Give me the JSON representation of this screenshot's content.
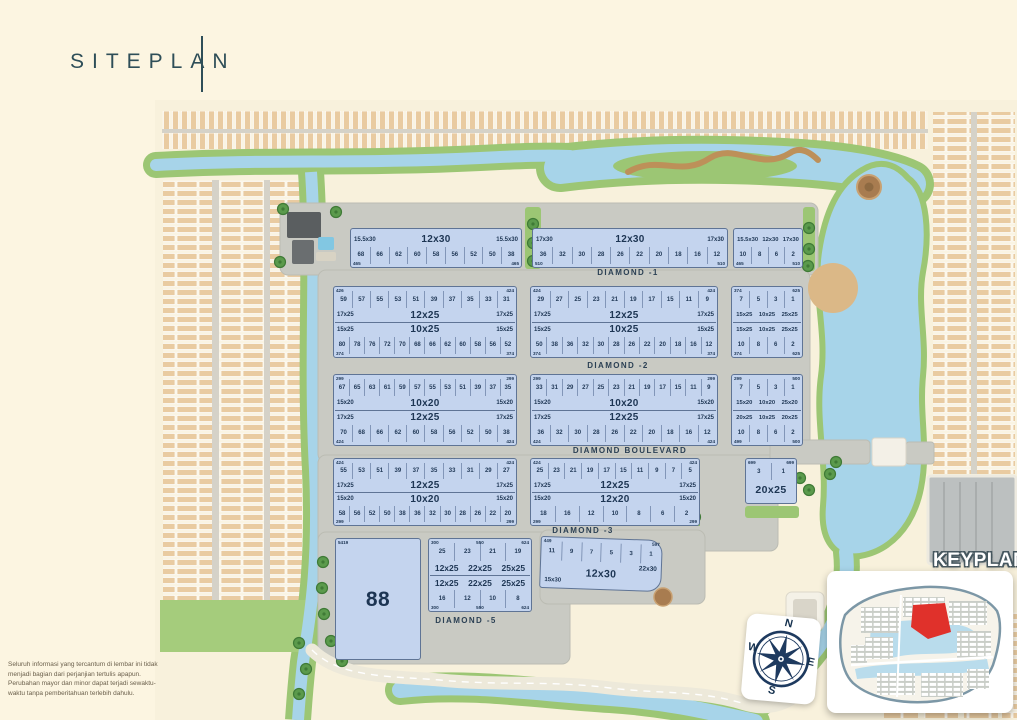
{
  "page": {
    "title": "SITEPLAN",
    "disclaimer": "Seluruh informasi yang tercantum di lembar ini tidak menjadi bagian dari perjanjian tertulis apapun. Perubahan mayor dan minor dapat terjadi sewaktu-waktu tanpa pemberitahuan terlebih dahulu."
  },
  "roads": [
    {
      "id": "diamond-1",
      "label": "DIAMOND -1"
    },
    {
      "id": "diamond-2",
      "label": "DIAMOND -2"
    },
    {
      "id": "diamond-boulevard",
      "label": "DIAMOND BOULEVARD"
    },
    {
      "id": "diamond-3",
      "label": "DIAMOND -3"
    },
    {
      "id": "diamond-5",
      "label": "DIAMOND -5"
    }
  ],
  "keyplan": {
    "label": "KEYPLAN"
  },
  "compass": {
    "n": "N",
    "e": "E",
    "s": "S",
    "w": "W"
  },
  "colors": {
    "lot_fill": "#C4D4EE",
    "lot_border": "#5F7495",
    "water": "#A7D4E9",
    "green": "#9CC674",
    "road_gray": "#C9CAC3",
    "text_navy": "#223A58",
    "keyplan_highlight": "#E0312B",
    "background_cream": "#FCF5E1",
    "title_color": "#2E4E58"
  },
  "blocks": [
    {
      "id": "b1",
      "corners": {
        "bl": "465",
        "br": "465"
      },
      "rows": [
        {
          "kind": "labels",
          "left": "15.5x30",
          "center": "12x30",
          "right": "15.5x30"
        },
        {
          "kind": "nums",
          "values": [
            "68",
            "66",
            "62",
            "60",
            "58",
            "56",
            "52",
            "50",
            "38"
          ]
        }
      ]
    },
    {
      "id": "b2",
      "corners": {
        "bl": "510",
        "br": "510"
      },
      "rows": [
        {
          "kind": "labels",
          "left": "17x30",
          "center": "12x30",
          "right": "17x30"
        },
        {
          "kind": "nums",
          "values": [
            "36",
            "32",
            "30",
            "28",
            "26",
            "22",
            "20",
            "18",
            "16",
            "12"
          ]
        }
      ]
    },
    {
      "id": "b3",
      "corners": {
        "bl": "465",
        "br": "510"
      },
      "rows": [
        {
          "kind": "labels3",
          "values": [
            "15.5x30",
            "12x30",
            "17x30"
          ]
        },
        {
          "kind": "nums",
          "values": [
            "10",
            "8",
            "6",
            "2"
          ]
        }
      ]
    },
    {
      "id": "b4",
      "corners": {
        "tl": "426",
        "tr": "424",
        "bl": "374",
        "br": "374"
      },
      "rows": [
        {
          "kind": "nums",
          "values": [
            "59",
            "57",
            "55",
            "53",
            "51",
            "39",
            "37",
            "35",
            "33",
            "31"
          ]
        },
        {
          "kind": "labels",
          "left": "17x25",
          "center": "12x25",
          "right": "17x25"
        },
        {
          "kind": "labels",
          "left": "15x25",
          "center": "10x25",
          "right": "15x25",
          "mid": true
        },
        {
          "kind": "nums",
          "values": [
            "80",
            "78",
            "76",
            "72",
            "70",
            "68",
            "66",
            "62",
            "60",
            "58",
            "56",
            "52"
          ]
        }
      ]
    },
    {
      "id": "b5",
      "corners": {
        "tl": "424",
        "tr": "424",
        "bl": "374",
        "br": "374"
      },
      "rows": [
        {
          "kind": "nums",
          "values": [
            "29",
            "27",
            "25",
            "23",
            "21",
            "19",
            "17",
            "15",
            "11",
            "9"
          ]
        },
        {
          "kind": "labels",
          "left": "17x25",
          "center": "12x25",
          "right": "17x25"
        },
        {
          "kind": "labels",
          "left": "15x25",
          "center": "10x25",
          "right": "15x25",
          "mid": true
        },
        {
          "kind": "nums",
          "values": [
            "50",
            "38",
            "36",
            "32",
            "30",
            "28",
            "26",
            "22",
            "20",
            "18",
            "16",
            "12"
          ]
        }
      ]
    },
    {
      "id": "b6",
      "corners": {
        "tl": "374",
        "tr": "625",
        "bl": "374",
        "br": "625"
      },
      "rows": [
        {
          "kind": "nums",
          "values": [
            "7",
            "5",
            "3",
            "1"
          ]
        },
        {
          "kind": "labels3",
          "values": [
            "15x25",
            "10x25",
            "25x25"
          ]
        },
        {
          "kind": "labels3",
          "values": [
            "15x25",
            "10x25",
            "25x25"
          ],
          "mid": true
        },
        {
          "kind": "nums",
          "values": [
            "10",
            "8",
            "6",
            "2"
          ]
        }
      ]
    },
    {
      "id": "b7",
      "corners": {
        "tl": "299",
        "tr": "299",
        "bl": "424",
        "br": "424"
      },
      "rows": [
        {
          "kind": "nums",
          "values": [
            "67",
            "65",
            "63",
            "61",
            "59",
            "57",
            "55",
            "53",
            "51",
            "39",
            "37",
            "35"
          ]
        },
        {
          "kind": "labels",
          "left": "15x20",
          "center": "10x20",
          "right": "15x20"
        },
        {
          "kind": "labels",
          "left": "17x25",
          "center": "12x25",
          "right": "17x25",
          "mid": true
        },
        {
          "kind": "nums",
          "values": [
            "70",
            "68",
            "66",
            "62",
            "60",
            "58",
            "56",
            "52",
            "50",
            "38"
          ]
        }
      ]
    },
    {
      "id": "b8",
      "corners": {
        "tl": "299",
        "tr": "299",
        "bl": "424",
        "br": "424"
      },
      "rows": [
        {
          "kind": "nums",
          "values": [
            "33",
            "31",
            "29",
            "27",
            "25",
            "23",
            "21",
            "19",
            "17",
            "15",
            "11",
            "9"
          ]
        },
        {
          "kind": "labels",
          "left": "15x20",
          "center": "10x20",
          "right": "15x20"
        },
        {
          "kind": "labels",
          "left": "17x25",
          "center": "12x25",
          "right": "17x25",
          "mid": true
        },
        {
          "kind": "nums",
          "values": [
            "36",
            "32",
            "30",
            "28",
            "26",
            "22",
            "20",
            "18",
            "16",
            "12"
          ]
        }
      ]
    },
    {
      "id": "b9",
      "corners": {
        "tl": "299",
        "tr": "500",
        "bl": "499",
        "br": "500"
      },
      "rows": [
        {
          "kind": "nums",
          "values": [
            "7",
            "5",
            "3",
            "1"
          ]
        },
        {
          "kind": "labels3",
          "values": [
            "15x20",
            "10x20",
            "25x20"
          ]
        },
        {
          "kind": "labels3",
          "values": [
            "20x25",
            "10x25",
            "20x25"
          ],
          "mid": true
        },
        {
          "kind": "nums",
          "values": [
            "10",
            "8",
            "6",
            "2"
          ]
        }
      ]
    },
    {
      "id": "b10",
      "corners": {
        "tl": "424",
        "tr": "424",
        "bl": "299",
        "br": "299"
      },
      "rows": [
        {
          "kind": "nums",
          "values": [
            "55",
            "53",
            "51",
            "39",
            "37",
            "35",
            "33",
            "31",
            "29",
            "27"
          ]
        },
        {
          "kind": "labels",
          "left": "17x25",
          "center": "12x25",
          "right": "17x25"
        },
        {
          "kind": "labels",
          "left": "15x20",
          "center": "10x20",
          "right": "15x20",
          "mid": true
        },
        {
          "kind": "nums",
          "values": [
            "58",
            "56",
            "52",
            "50",
            "38",
            "36",
            "32",
            "30",
            "28",
            "26",
            "22",
            "20"
          ]
        }
      ]
    },
    {
      "id": "b11",
      "corners": {
        "tl": "424",
        "tr": "424",
        "bl": "299",
        "br": "299"
      },
      "rows": [
        {
          "kind": "nums",
          "values": [
            "25",
            "23",
            "21",
            "19",
            "17",
            "15",
            "11",
            "9",
            "7",
            "5"
          ]
        },
        {
          "kind": "labels",
          "left": "17x25",
          "center": "12x25",
          "right": "17x25"
        },
        {
          "kind": "labels",
          "left": "15x20",
          "center": "12x20",
          "right": "15x20",
          "mid": true
        },
        {
          "kind": "nums",
          "values": [
            "18",
            "16",
            "12",
            "10",
            "8",
            "6",
            "2"
          ]
        }
      ]
    },
    {
      "id": "b12",
      "corners": {
        "tl": "699",
        "tr": "699"
      },
      "rows": [
        {
          "kind": "nums",
          "values": [
            "3",
            "1"
          ]
        },
        {
          "kind": "big",
          "text": "20x25"
        }
      ]
    },
    {
      "id": "b13",
      "corners": {
        "tl": "5419"
      },
      "rows": [
        {
          "kind": "big",
          "text": "88"
        }
      ]
    },
    {
      "id": "b14",
      "corners": {
        "tl": "300",
        "tc": "550",
        "tr": "624",
        "bl": "300",
        "bc": "550",
        "br": "624"
      },
      "rows": [
        {
          "kind": "nums",
          "values": [
            "25",
            "23",
            "21",
            "19"
          ]
        },
        {
          "kind": "labels3",
          "values": [
            "12x25",
            "22x25",
            "25x25"
          ]
        },
        {
          "kind": "labels3",
          "values": [
            "12x25",
            "22x25",
            "25x25"
          ],
          "mid": true
        },
        {
          "kind": "nums",
          "values": [
            "16",
            "12",
            "10",
            "8"
          ]
        }
      ]
    },
    {
      "id": "b15",
      "corners": {
        "tl": "449",
        "tr": "597"
      },
      "rows": [
        {
          "kind": "nums",
          "values": [
            "11",
            "9",
            "7",
            "5",
            "3",
            "1"
          ]
        },
        {
          "kind": "mix",
          "left": "15x30",
          "center": "12x30",
          "right": "22x30"
        }
      ]
    }
  ]
}
